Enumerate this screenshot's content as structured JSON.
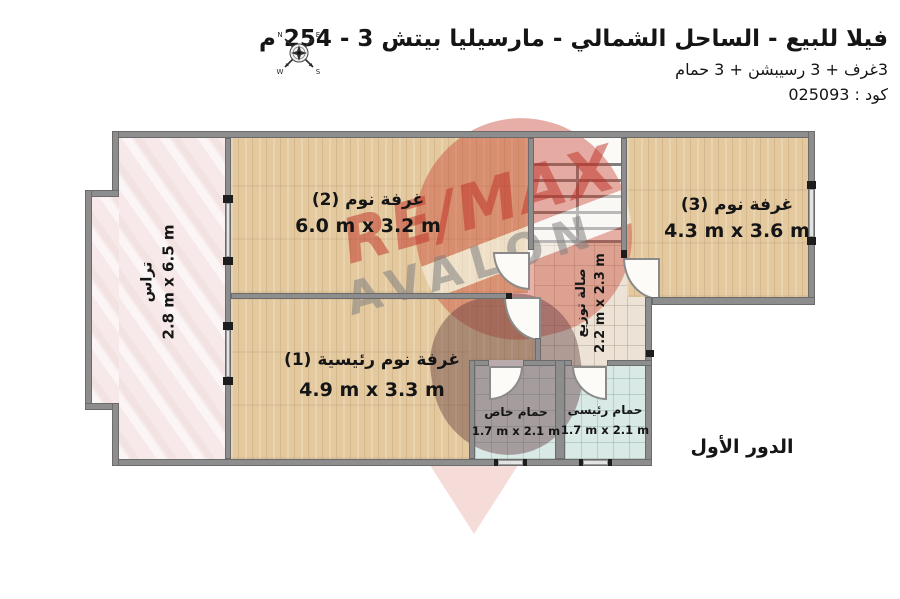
{
  "header": {
    "title": "فيلا للبيع - الساحل الشمالي - مارسيليا بيتش 3 - 254 م",
    "subtitle": "3غرف + 3 رسيبشن + 3 حمام",
    "code": "كود : 025093"
  },
  "compass": {
    "n": "N",
    "e": "E",
    "s": "S",
    "w": "W"
  },
  "floor_label": "الدور الأول",
  "watermark": {
    "line1": "RE/MAX",
    "line2": "AVALON"
  },
  "rooms": {
    "bedroom2": {
      "name": "غرفة نوم (2)",
      "dims": "6.0 m x 3.2 m"
    },
    "bedroom3": {
      "name": "غرفة نوم (3)",
      "dims": "4.3 m x 3.6 m"
    },
    "master": {
      "name": "غرفة نوم رئيسية (1)",
      "dims": "4.9 m x 3.3 m"
    },
    "terrace": {
      "name": "تراس",
      "dims": "2.8 m x 6.5 m"
    },
    "hall": {
      "name": "صالة توزيع",
      "dims": "2.2 m x 2.3 m"
    },
    "bath_private": {
      "name": "حمام خاص",
      "dims": "1.7 m x 2.1 m"
    },
    "bath_master": {
      "name": "حمام رئيسى",
      "dims": "1.7 m x 2.1 m"
    }
  },
  "colors": {
    "wall": "#8d8d8d",
    "wood": "#e4c99f",
    "terrace": "#f7e9e9",
    "hall": "#ece3d6",
    "bath": "#d9e9e5",
    "accent-red": "#c53b2e"
  }
}
